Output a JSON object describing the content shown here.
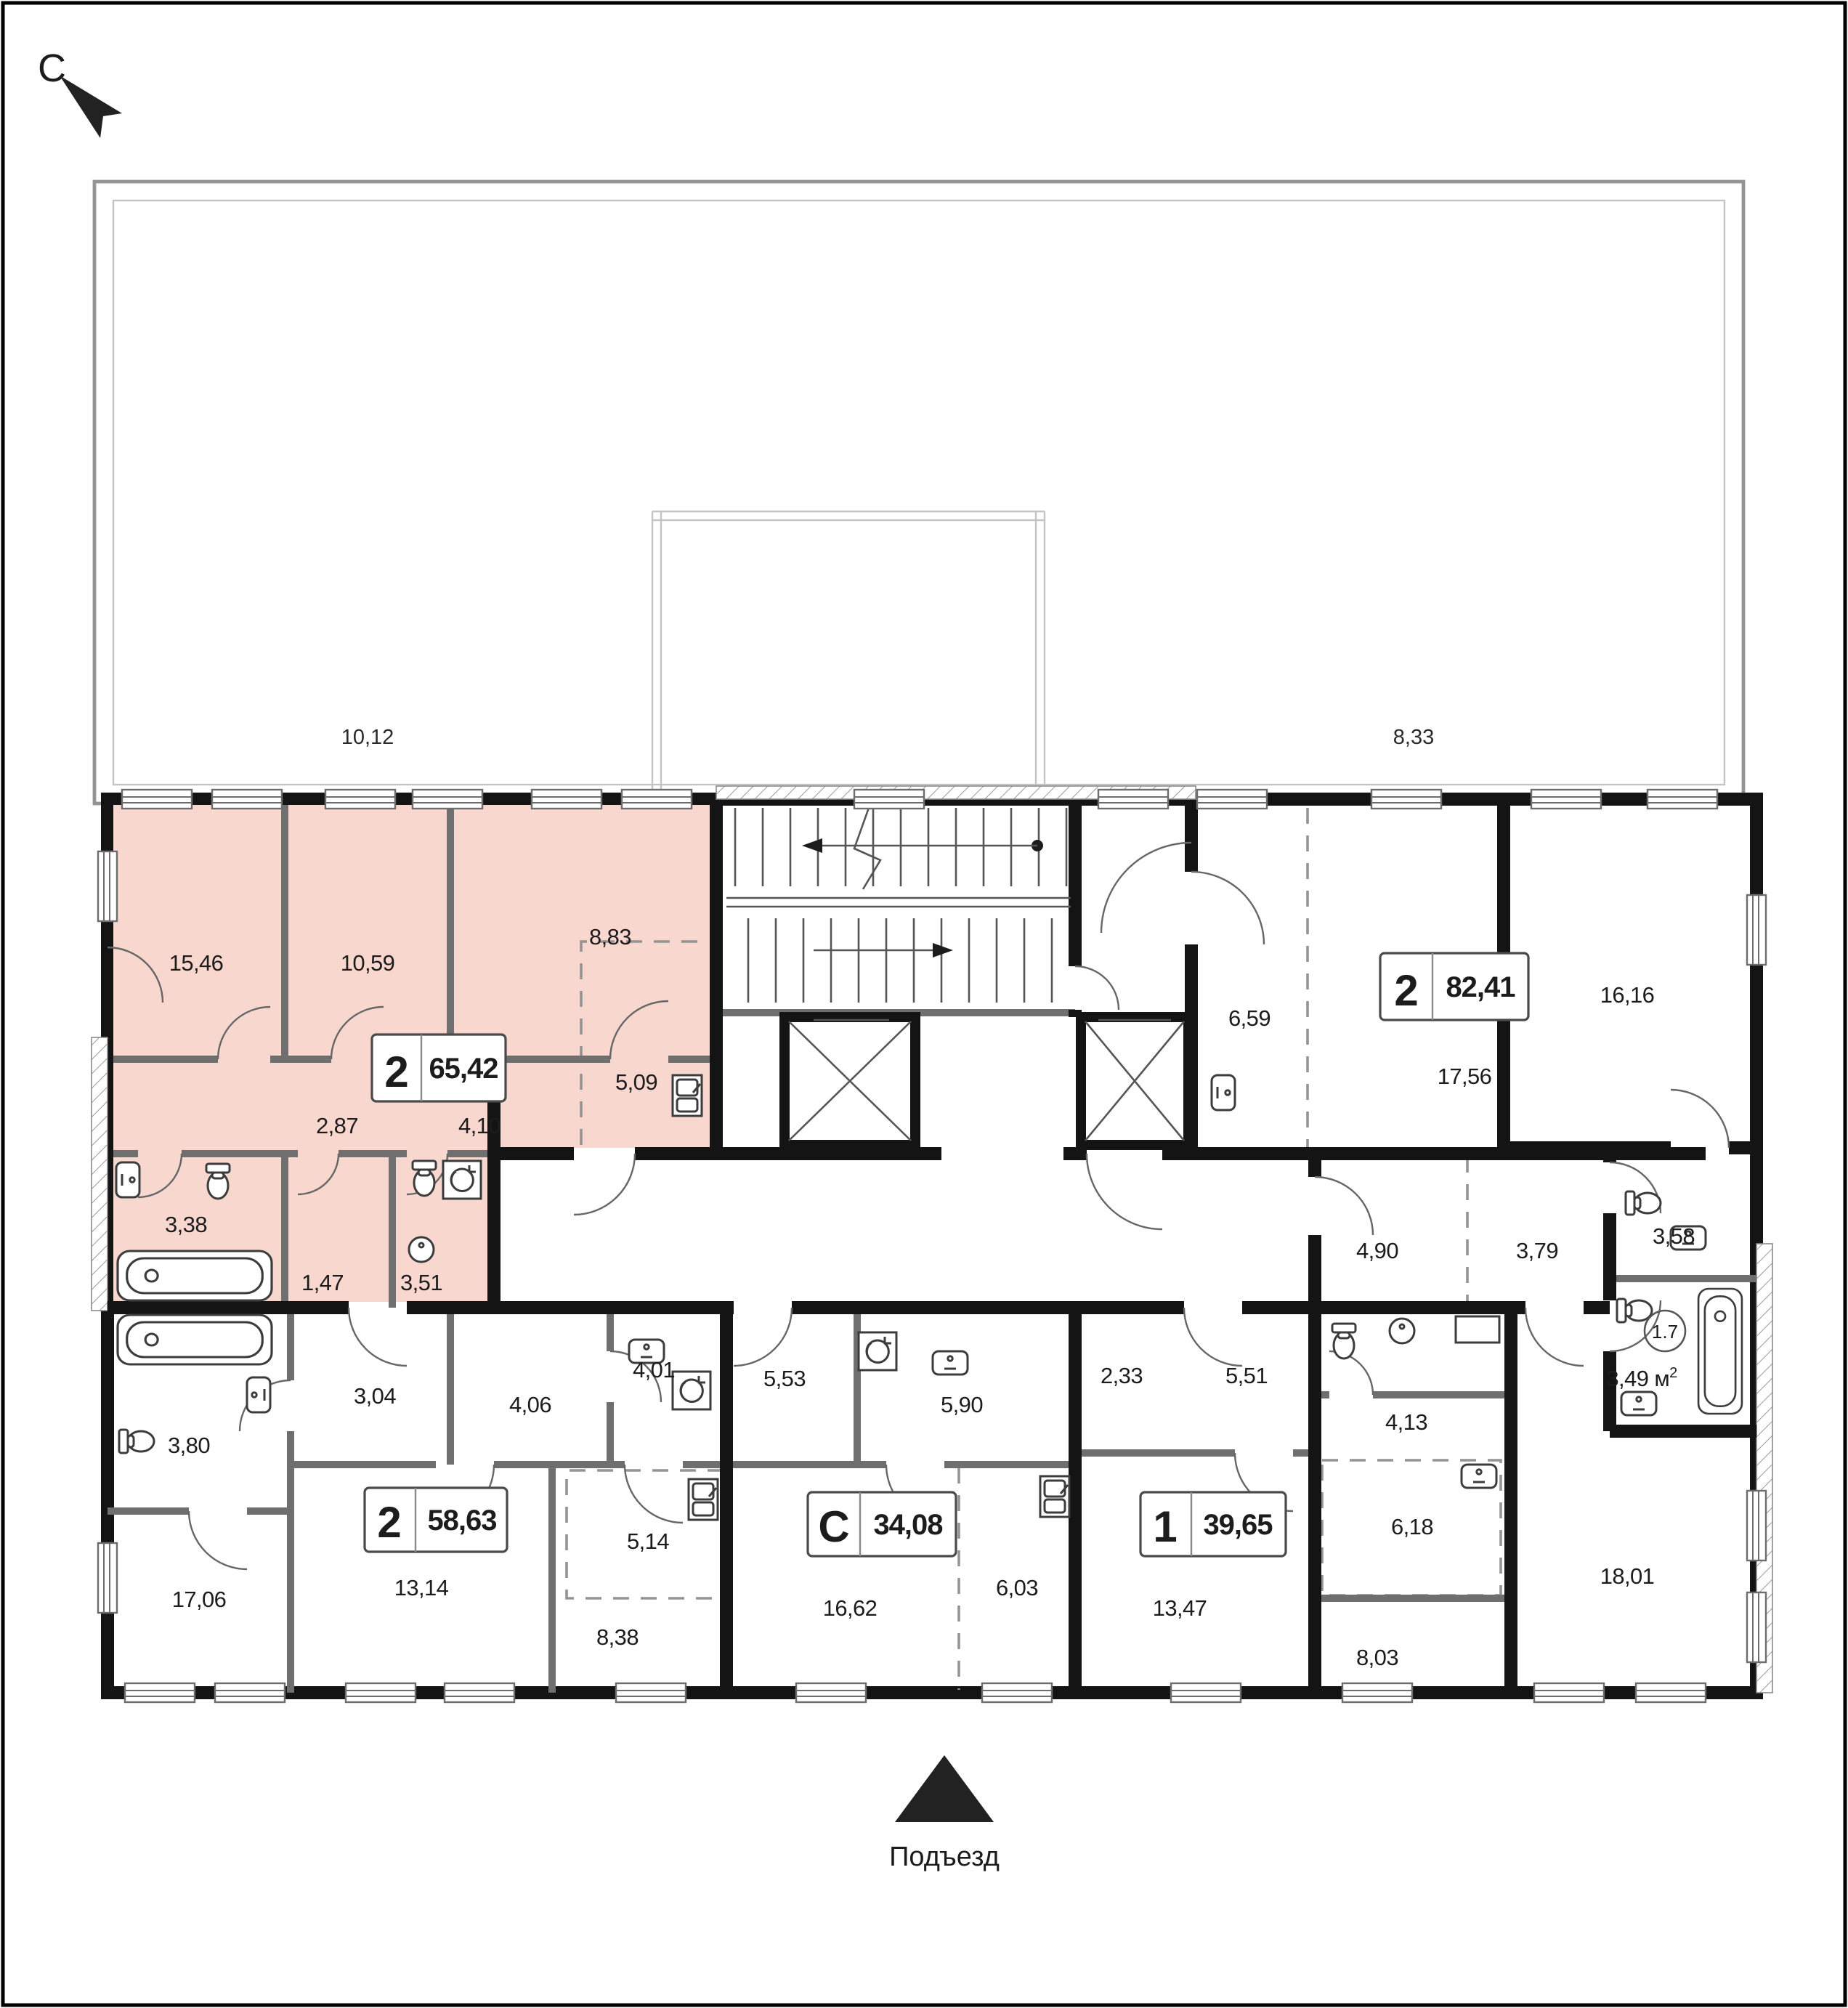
{
  "compass": {
    "label": "С"
  },
  "entrance": {
    "label": "Подъезд"
  },
  "terraces": {
    "left_area": "10,12",
    "right_area": "8,33"
  },
  "colors": {
    "highlight_fill": "#f8d7cf",
    "highlight_stroke": "#edbfb2",
    "wall": "#141414",
    "partition": "#6f6f6f"
  },
  "apartments": {
    "a65": {
      "type": "2",
      "total_area": "65,42",
      "highlighted": true,
      "rooms": {
        "r1546": "15,46",
        "r1059": "10,59",
        "r883": "8,83",
        "r509": "5,09",
        "r287": "2,87",
        "r410": "4,10",
        "r338": "3,38",
        "r147": "1,47",
        "r351": "3,51"
      }
    },
    "a82": {
      "type": "2",
      "total_area": "82,41",
      "highlighted": false,
      "rooms": {
        "r659": "6,59",
        "r1756": "17,56",
        "r1616": "16,16",
        "r490": "4,90",
        "r379": "3,79",
        "r358": "3,58",
        "r1801": "18,01",
        "r349": "3,49",
        "r349_unit": "м",
        "r349_sup": "2",
        "shaft": "1.7"
      }
    },
    "a58": {
      "type": "2",
      "total_area": "58,63",
      "highlighted": false,
      "rooms": {
        "r380": "3,80",
        "r304": "3,04",
        "r406": "4,06",
        "r401": "4,01",
        "r1706": "17,06",
        "r1314": "13,14",
        "r514": "5,14",
        "r838": "8,38"
      }
    },
    "aC": {
      "type": "С",
      "total_area": "34,08",
      "highlighted": false,
      "rooms": {
        "r553": "5,53",
        "r590": "5,90",
        "r1662": "16,62",
        "r603": "6,03"
      }
    },
    "a39": {
      "type": "1",
      "total_area": "39,65",
      "highlighted": false,
      "rooms": {
        "r233": "2,33",
        "r551": "5,51",
        "r413": "4,13",
        "r1347": "13,47",
        "r618": "6,18",
        "r803": "8,03"
      }
    }
  }
}
